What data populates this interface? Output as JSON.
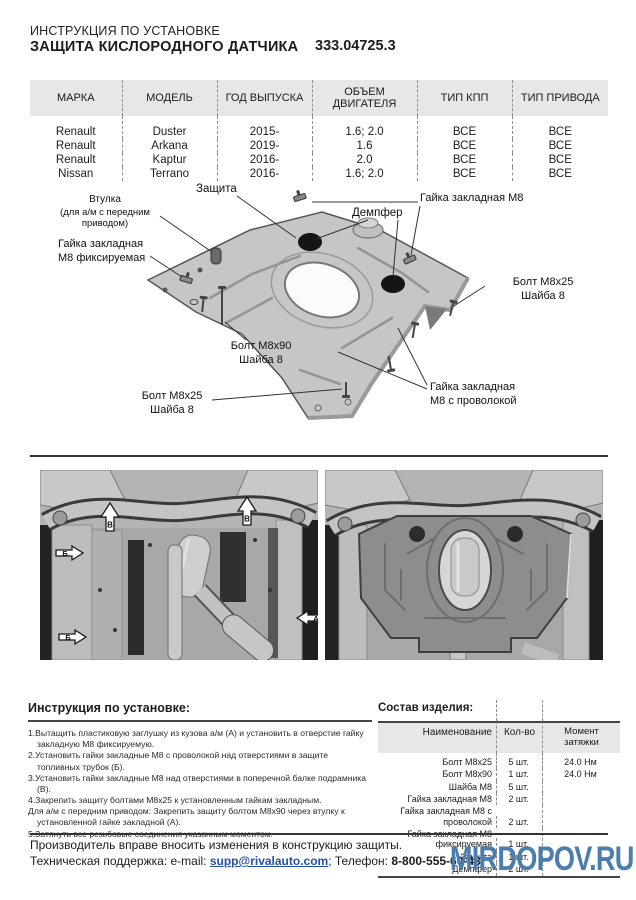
{
  "header": {
    "subtitle": "ИНСТРУКЦИЯ ПО УСТАНОВКЕ",
    "title": "ЗАЩИТА КИСЛОРОДНОГО ДАТЧИКА",
    "part_number": "333.04725.3"
  },
  "vehicle_table": {
    "headers": [
      "МАРКА",
      "МОДЕЛЬ",
      "ГОД ВЫПУСКА",
      "ОБЪЕМ ДВИГАТЕЛЯ",
      "ТИП КПП",
      "ТИП ПРИВОДА"
    ],
    "rows": [
      {
        "brand": "Renault",
        "model": "Duster",
        "year": "2015-",
        "engine": "1.6; 2.0",
        "gearbox": "ВСЕ",
        "drive": "ВСЕ"
      },
      {
        "brand": "Renault",
        "model": "Arkana",
        "year": "2019-",
        "engine": "1.6",
        "gearbox": "ВСЕ",
        "drive": "ВСЕ"
      },
      {
        "brand": "Renault",
        "model": "Kaptur",
        "year": "2016-",
        "engine": "2.0",
        "gearbox": "ВСЕ",
        "drive": "ВСЕ"
      },
      {
        "brand": "Nissan",
        "model": "Terrano",
        "year": "2016-",
        "engine": "1.6; 2.0",
        "gearbox": "ВСЕ",
        "drive": "ВСЕ"
      }
    ]
  },
  "diagram": {
    "labels": {
      "shield": "Защита",
      "bushing_1": "Втулка",
      "bushing_2": "(для а/м с передним приводом)",
      "nut_fixed_1": "Гайка закладная",
      "nut_fixed_2": "М8 фиксируемая",
      "nut_m8": "Гайка закладная М8",
      "damper": "Демпфер",
      "bolt_m8x25": "Болт М8х25",
      "washer_8": "Шайба 8",
      "bolt_m8x90": "Болт М8х90",
      "nut_wire_1": "Гайка закладная",
      "nut_wire_2": "М8 с проволокой"
    }
  },
  "photos": {
    "markers": {
      "a": "А",
      "b": "Б",
      "v": "В"
    }
  },
  "install": {
    "title": "Инструкция по установке:",
    "steps": [
      "1.Вытащить пластиковую заглушку из кузова а/м (А) и установить в отверстие гайку закладную М8 фиксируемую.",
      "2.Установить гайки закладные М8 с проволокой над отверстиями в защите топливных трубок (Б).",
      "3.Установить гайки закладные М8 над отверстиями в поперечной балке подрамника (В).",
      "4.Закрепить защиту болтами М8х25 к установленным гайкам закладным.",
      "Для а/м с передним приводом: Закрепить защиту болтом М8х90 через втулку к установленной гайке закладной (А).",
      "5.Затянуть все резьбовые соединения указанным моментом."
    ]
  },
  "parts": {
    "title": "Состав изделия:",
    "headers": [
      "Наименование",
      "Кол-во",
      "Момент затяжки"
    ],
    "rows": [
      {
        "name": "Болт М8х25",
        "qty": "5 шт.",
        "torque": "24.0 Нм"
      },
      {
        "name": "Болт М8х90",
        "qty": "1 шт.",
        "torque": "24.0 Нм"
      },
      {
        "name": "Шайба М8",
        "qty": "5 шт.",
        "torque": ""
      },
      {
        "name": "Гайка закладная М8",
        "qty": "2 шт.",
        "torque": ""
      },
      {
        "name": "Гайка закладная М8 с проволокой",
        "qty": "2 шт.",
        "torque": ""
      },
      {
        "name": "Гайка закладная М8 фиксируемая",
        "qty": "1 шт.",
        "torque": ""
      },
      {
        "name": "Защита",
        "qty": "1 шт.",
        "torque": ""
      },
      {
        "name": "Демпфер",
        "qty": "2 шт.",
        "torque": ""
      }
    ]
  },
  "footer": {
    "line1": "Производитель вправе вносить изменения в конструкцию защиты.",
    "support_label": "Техническая поддержка:  e-mail: ",
    "email": "supp@rivalauto.com",
    "phone_label": "; Телефон: ",
    "phone": "8-800-555-60-43"
  },
  "watermark": {
    "text": "MIRDOPOV.RU",
    "color": "#4b7dad"
  },
  "colors": {
    "table_header_bg": "#e7e7e7",
    "link_blue": "#2450ae",
    "watermark_blue": "#4b7dad"
  }
}
